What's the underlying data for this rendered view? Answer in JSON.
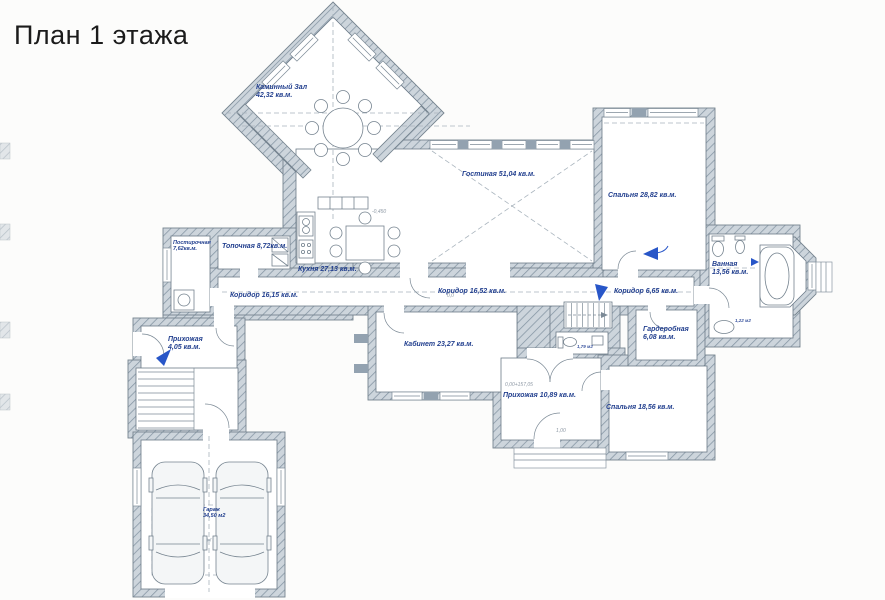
{
  "title": "План 1 этажа",
  "plan": {
    "rooms": [
      {
        "id": "fireplace-hall",
        "name": "Каминный Зал",
        "area": "42,32 кв.м.",
        "x": 256,
        "y": 84,
        "two_line": true
      },
      {
        "id": "living-room",
        "name": "Гостиная",
        "area": "51,04 кв.м.",
        "x": 462,
        "y": 171,
        "two_line": false
      },
      {
        "id": "bedroom-1",
        "name": "Спальня",
        "area": "28,82 кв.м.",
        "x": 608,
        "y": 192,
        "two_line": false
      },
      {
        "id": "bathroom",
        "name": "Ванная",
        "area": "13,56 кв.м.",
        "x": 712,
        "y": 261,
        "two_line": true
      },
      {
        "id": "laundry",
        "name": "Постирочная",
        "area": "7,62кв.м.",
        "x": 173,
        "y": 240,
        "two_line": true,
        "small": true
      },
      {
        "id": "boiler-room",
        "name": "Топочная",
        "area": "8,72кв.м.",
        "x": 222,
        "y": 243,
        "two_line": false
      },
      {
        "id": "kitchen",
        "name": "Кухня",
        "area": "27,13 кв.м.",
        "x": 298,
        "y": 266,
        "two_line": false
      },
      {
        "id": "corridor-west",
        "name": "Коридор",
        "area": "16,15 кв.м.",
        "x": 230,
        "y": 292,
        "two_line": false
      },
      {
        "id": "corridor-center",
        "name": "Коридор",
        "area": "16,52 кв.м.",
        "x": 438,
        "y": 288,
        "two_line": false
      },
      {
        "id": "corridor-east",
        "name": "Коридор",
        "area": "6,65 кв.м.",
        "x": 614,
        "y": 288,
        "two_line": false
      },
      {
        "id": "wardrobe",
        "name": "Гардеробная",
        "area": "6,08 кв.м.",
        "x": 643,
        "y": 326,
        "two_line": true
      },
      {
        "id": "hallway-small",
        "name": "Прихожая",
        "area": "4,05 кв.м.",
        "x": 168,
        "y": 336,
        "two_line": true
      },
      {
        "id": "study",
        "name": "Кабинет",
        "area": "23,27 кв.м.",
        "x": 404,
        "y": 341,
        "two_line": false
      },
      {
        "id": "hallway-main",
        "name": "Прихожая",
        "area": "10,89 кв.м.",
        "x": 503,
        "y": 392,
        "two_line": false
      },
      {
        "id": "bedroom-2",
        "name": "Спальня",
        "area": "18,56 кв.м.",
        "x": 606,
        "y": 404,
        "two_line": false
      },
      {
        "id": "garage",
        "name": "Гараж",
        "area": "34,50 м2",
        "x": 203,
        "y": 507,
        "two_line": true,
        "small": true
      }
    ],
    "small_labels": [
      {
        "id": "wc-area",
        "text": "1,79 м2",
        "x": 577,
        "y": 344
      },
      {
        "id": "bath-closet-area",
        "text": "1,22 м2",
        "x": 735,
        "y": 318
      }
    ],
    "level_marks": [
      {
        "text": "-0,450",
        "x": 372,
        "y": 210
      },
      {
        "text": "0,0",
        "x": 447,
        "y": 294
      },
      {
        "text": "0,00+157,05",
        "x": 505,
        "y": 383
      },
      {
        "text": "1,00",
        "x": 556,
        "y": 429
      }
    ]
  },
  "colors": {
    "wall_fill": "#cdd5dc",
    "wall_hatch": "#8494a2",
    "outline": "#6b7a88",
    "label": "#23408f",
    "direction_arrow": "#2856c8",
    "level_mark": "#8d98a4",
    "background": "#fcfcfb"
  }
}
